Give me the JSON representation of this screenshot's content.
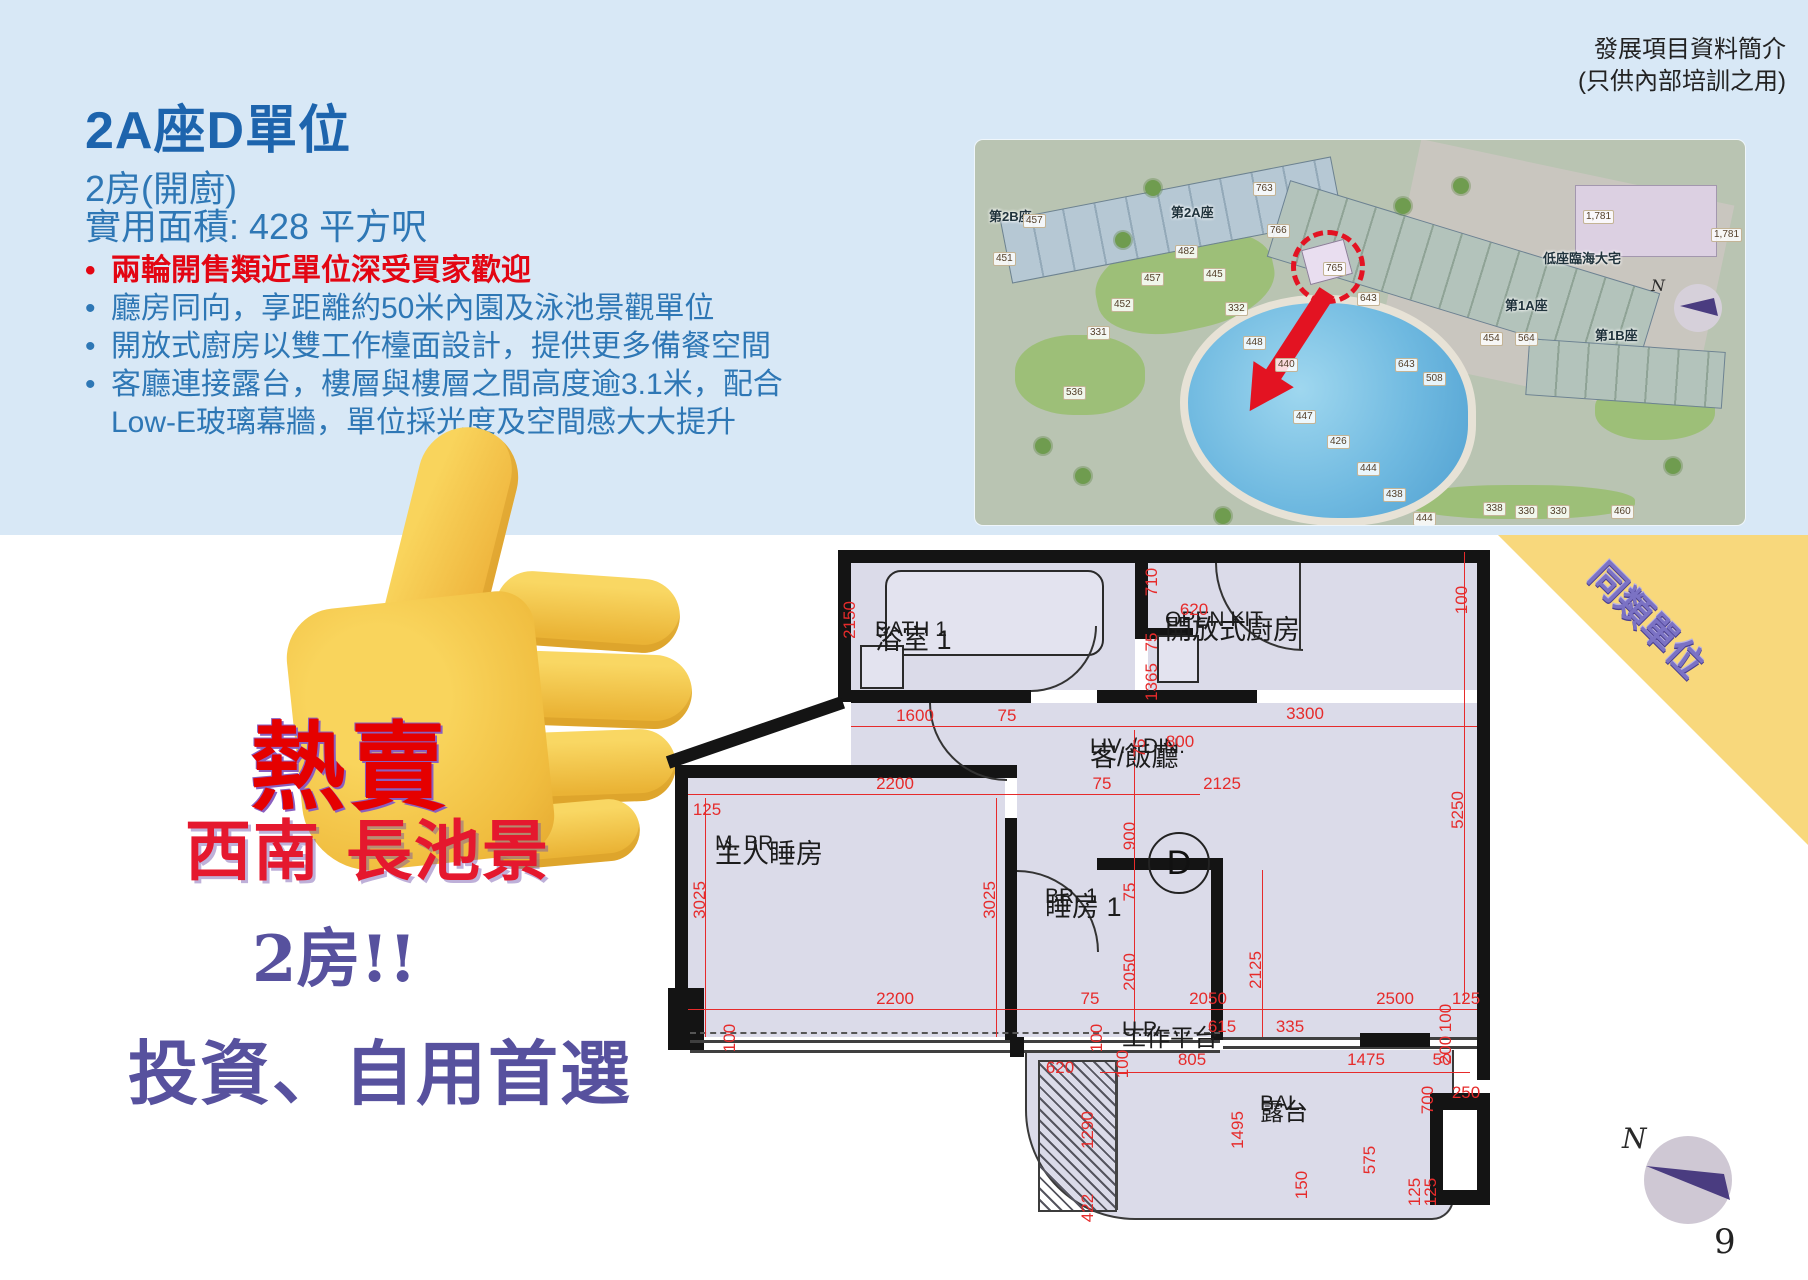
{
  "page": {
    "number": "9"
  },
  "header_note": {
    "line1": "發展項目資料簡介",
    "line2": "(只供內部培訓之用)"
  },
  "title": {
    "heading": "2A座D單位",
    "subtitle_rooms": "2房(開廚)",
    "subtitle_area": "實用面積: 428 平方呎"
  },
  "bullets": {
    "b1": "兩輪開售類近單位深受買家歡迎",
    "b2": "廳房同向，享距離約50米內園及泳池景觀單位",
    "b3": "開放式廚房以雙工作檯面設計，提供更多備餐空間",
    "b4": "客廳連接露台，樓層與樓層之間高度逾3.1米，配合",
    "b4b": "Low-E玻璃幕牆，單位採光度及空間感大大提升"
  },
  "stickers": {
    "hot_sale": "熱賣",
    "view": "西南 長池景",
    "rooms": "2房!!",
    "pitch": "投資、自用首選",
    "thumb_emoji": "thumbs-up"
  },
  "corner_banner": {
    "line1": "同類單位",
    "line2": "首兩輪推售近清"
  },
  "site_map": {
    "compass_label": "N",
    "labels": [
      {
        "t": "第2B座",
        "x": 14,
        "y": 66,
        "k": "tower"
      },
      {
        "t": "第2A座",
        "x": 196,
        "y": 62,
        "k": "tower"
      },
      {
        "t": "第1A座",
        "x": 530,
        "y": 155,
        "k": "tower"
      },
      {
        "t": "第1B座",
        "x": 620,
        "y": 185,
        "k": "tower"
      },
      {
        "t": "低座臨海大宅",
        "x": 568,
        "y": 108,
        "k": "tower"
      },
      {
        "t": "457",
        "x": 48,
        "y": 74,
        "k": "num"
      },
      {
        "t": "451",
        "x": 18,
        "y": 112,
        "k": "num"
      },
      {
        "t": "482",
        "x": 200,
        "y": 105,
        "k": "num"
      },
      {
        "t": "457",
        "x": 166,
        "y": 132,
        "k": "num"
      },
      {
        "t": "445",
        "x": 228,
        "y": 128,
        "k": "num"
      },
      {
        "t": "332",
        "x": 250,
        "y": 162,
        "k": "num"
      },
      {
        "t": "448",
        "x": 268,
        "y": 196,
        "k": "num"
      },
      {
        "t": "331",
        "x": 112,
        "y": 186,
        "k": "num"
      },
      {
        "t": "536",
        "x": 88,
        "y": 246,
        "k": "num"
      },
      {
        "t": "452",
        "x": 136,
        "y": 158,
        "k": "num"
      },
      {
        "t": "440",
        "x": 300,
        "y": 218,
        "k": "num"
      },
      {
        "t": "447",
        "x": 318,
        "y": 270,
        "k": "num"
      },
      {
        "t": "426",
        "x": 352,
        "y": 295,
        "k": "num"
      },
      {
        "t": "444",
        "x": 382,
        "y": 322,
        "k": "num"
      },
      {
        "t": "438",
        "x": 408,
        "y": 348,
        "k": "num"
      },
      {
        "t": "444",
        "x": 438,
        "y": 372,
        "k": "num"
      },
      {
        "t": "763",
        "x": 278,
        "y": 42,
        "k": "num"
      },
      {
        "t": "766",
        "x": 292,
        "y": 84,
        "k": "num"
      },
      {
        "t": "765",
        "x": 348,
        "y": 122,
        "k": "num"
      },
      {
        "t": "643",
        "x": 382,
        "y": 152,
        "k": "num"
      },
      {
        "t": "643",
        "x": 420,
        "y": 218,
        "k": "num"
      },
      {
        "t": "508",
        "x": 448,
        "y": 232,
        "k": "num"
      },
      {
        "t": "454",
        "x": 505,
        "y": 192,
        "k": "num"
      },
      {
        "t": "564",
        "x": 540,
        "y": 192,
        "k": "num"
      },
      {
        "t": "1,781",
        "x": 608,
        "y": 70,
        "k": "num"
      },
      {
        "t": "1,781",
        "x": 736,
        "y": 88,
        "k": "num"
      },
      {
        "t": "338",
        "x": 508,
        "y": 362,
        "k": "num"
      },
      {
        "t": "330",
        "x": 540,
        "y": 365,
        "k": "num"
      },
      {
        "t": "330",
        "x": 572,
        "y": 365,
        "k": "num"
      },
      {
        "t": "460",
        "x": 636,
        "y": 365,
        "k": "num"
      }
    ]
  },
  "floor_plan": {
    "rooms": {
      "bath": {
        "zh": "浴室 1",
        "en": "BATH 1"
      },
      "kitchen": {
        "zh": "開放式廚房",
        "en": "OPEN KIT."
      },
      "living": {
        "zh": "客/飯廳",
        "en": "LIV. / DIN.",
        "unit": "D"
      },
      "master": {
        "zh": "主人睡房",
        "en": "M. BR."
      },
      "bed1": {
        "zh": "睡房 1",
        "en": "BR. 1"
      },
      "utility": {
        "zh": "工作平台",
        "en": "U.P."
      },
      "balcony": {
        "zh": "露台",
        "en": "BAL."
      }
    },
    "dims": [
      {
        "t": "2150",
        "x": 190,
        "y": 80,
        "r": 90
      },
      {
        "t": "710",
        "x": 492,
        "y": 42,
        "r": 90
      },
      {
        "t": "620",
        "x": 534,
        "y": 70,
        "r": 0
      },
      {
        "t": "75",
        "x": 492,
        "y": 102,
        "r": 90
      },
      {
        "t": "1365",
        "x": 492,
        "y": 142,
        "r": 90
      },
      {
        "t": "100",
        "x": 802,
        "y": 60,
        "r": 90
      },
      {
        "t": "1600",
        "x": 255,
        "y": 176,
        "r": 0
      },
      {
        "t": "75",
        "x": 347,
        "y": 176,
        "r": 0
      },
      {
        "t": "3300",
        "x": 645,
        "y": 174,
        "r": 0
      },
      {
        "t": "75",
        "x": 480,
        "y": 208,
        "r": 90
      },
      {
        "t": "800",
        "x": 520,
        "y": 202,
        "r": 0
      },
      {
        "t": "2200",
        "x": 235,
        "y": 244,
        "r": 0
      },
      {
        "t": "75",
        "x": 442,
        "y": 244,
        "r": 0
      },
      {
        "t": "2125",
        "x": 562,
        "y": 244,
        "r": 0
      },
      {
        "t": "125",
        "x": 47,
        "y": 270,
        "r": 0
      },
      {
        "t": "900",
        "x": 470,
        "y": 296,
        "r": 90
      },
      {
        "t": "5250",
        "x": 798,
        "y": 270,
        "r": 90
      },
      {
        "t": "3025",
        "x": 40,
        "y": 360,
        "r": 90
      },
      {
        "t": "3025",
        "x": 330,
        "y": 360,
        "r": 90
      },
      {
        "t": "75",
        "x": 470,
        "y": 352,
        "r": 90
      },
      {
        "t": "2050",
        "x": 470,
        "y": 432,
        "r": 90
      },
      {
        "t": "2125",
        "x": 596,
        "y": 430,
        "r": 90
      },
      {
        "t": "2200",
        "x": 235,
        "y": 459,
        "r": 0
      },
      {
        "t": "75",
        "x": 430,
        "y": 459,
        "r": 0
      },
      {
        "t": "2050",
        "x": 548,
        "y": 459,
        "r": 0
      },
      {
        "t": "2500",
        "x": 735,
        "y": 459,
        "r": 0
      },
      {
        "t": "125",
        "x": 806,
        "y": 459,
        "r": 0
      },
      {
        "t": "615",
        "x": 562,
        "y": 487,
        "r": 0
      },
      {
        "t": "335",
        "x": 630,
        "y": 487,
        "r": 0
      },
      {
        "t": "100",
        "x": 70,
        "y": 498,
        "r": 90
      },
      {
        "t": "100",
        "x": 437,
        "y": 498,
        "r": 90
      },
      {
        "t": "100",
        "x": 786,
        "y": 478,
        "r": 90
      },
      {
        "t": "200",
        "x": 786,
        "y": 510,
        "r": 90
      },
      {
        "t": "100",
        "x": 463,
        "y": 524,
        "r": 90
      },
      {
        "t": "620",
        "x": 400,
        "y": 528,
        "r": 0
      },
      {
        "t": "805",
        "x": 532,
        "y": 520,
        "r": 0
      },
      {
        "t": "1475",
        "x": 706,
        "y": 520,
        "r": 0
      },
      {
        "t": "50",
        "x": 782,
        "y": 520,
        "r": 0
      },
      {
        "t": "700",
        "x": 768,
        "y": 560,
        "r": 90
      },
      {
        "t": "250",
        "x": 806,
        "y": 553,
        "r": 0
      },
      {
        "t": "1495",
        "x": 578,
        "y": 590,
        "r": 90
      },
      {
        "t": "1290",
        "x": 428,
        "y": 590,
        "r": 90
      },
      {
        "t": "575",
        "x": 710,
        "y": 620,
        "r": 90
      },
      {
        "t": "150",
        "x": 642,
        "y": 645,
        "r": 90
      },
      {
        "t": "422",
        "x": 428,
        "y": 668,
        "r": 90
      },
      {
        "t": "125",
        "x": 755,
        "y": 652,
        "r": 90
      },
      {
        "t": "125",
        "x": 771,
        "y": 652,
        "r": 90
      }
    ]
  },
  "compass": {
    "label": "N"
  }
}
